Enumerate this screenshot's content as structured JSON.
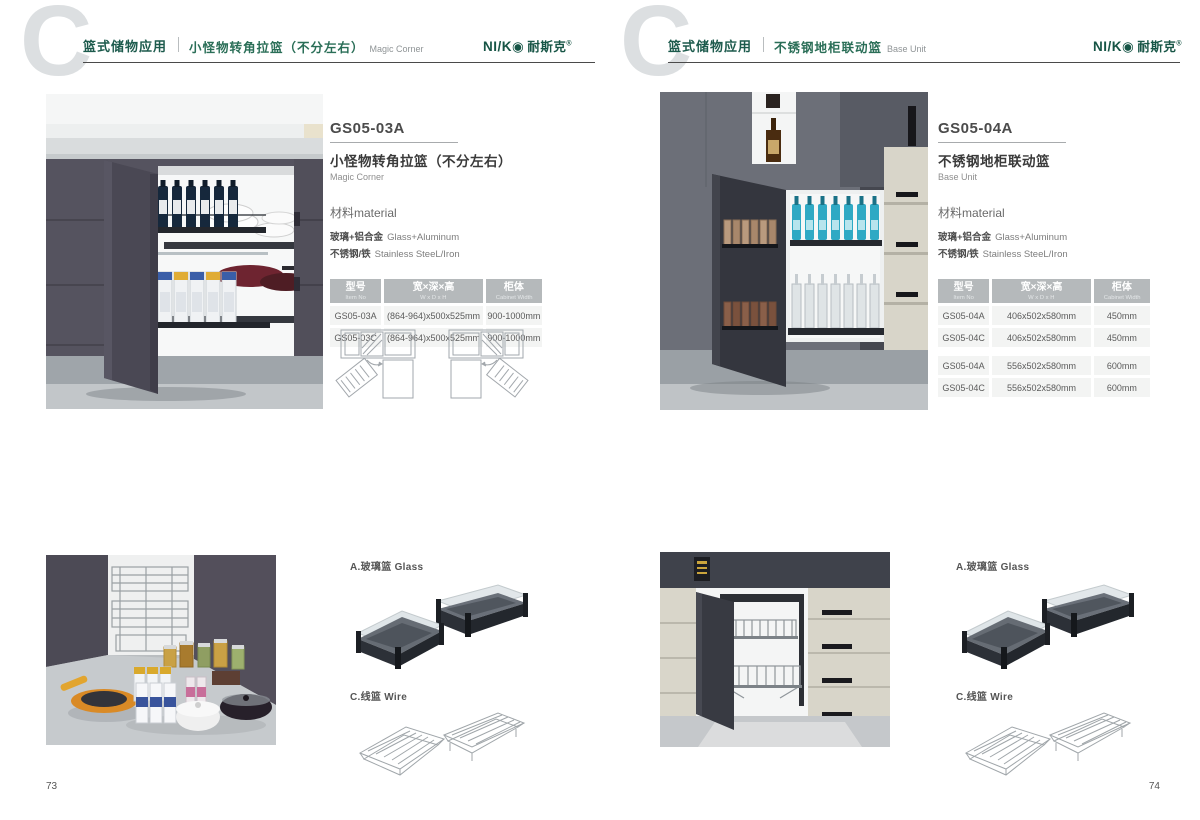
{
  "brand": {
    "logo_name": "NI/K◉",
    "logo_cn": "耐斯克",
    "reg": "®"
  },
  "watermark": "C",
  "material_heading": "材料material",
  "materials": [
    {
      "cn": "玻璃+铝合金",
      "en": "Glass+Aluminum"
    },
    {
      "cn": "不锈钢/铁",
      "en": "Stainless SteeL/Iron"
    }
  ],
  "table_headers": [
    {
      "cn": "型号",
      "en": "Item No"
    },
    {
      "cn": "宽×深×高",
      "en": "W x D x H"
    },
    {
      "cn": "柜体",
      "en": "Cabinet Width"
    }
  ],
  "legend": {
    "glass": "A.玻璃篮 Glass",
    "wire": "C.线篮 Wire"
  },
  "pages": [
    {
      "page_number": "73",
      "header": {
        "category": "篮式储物应用",
        "title_cn": "小怪物转角拉篮（不分左右）",
        "title_en": "Magic Corner"
      },
      "product": {
        "model": "GS05-03A",
        "name_cn": "小怪物转角拉篮（不分左右）",
        "name_en": "Magic Corner"
      },
      "rows": [
        {
          "model": "GS05-03A",
          "size": "(864-964)x500x525mm",
          "cabinet": "900-1000mm"
        },
        {
          "model": "GS05-03C",
          "size": "(864-964)x500x525mm",
          "cabinet": "900-1000mm"
        }
      ]
    },
    {
      "page_number": "74",
      "header": {
        "category": "篮式储物应用",
        "title_cn": "不锈钢地柜联动篮",
        "title_en": "Base Unit"
      },
      "product": {
        "model": "GS05-04A",
        "name_cn": "不锈钢地柜联动篮",
        "name_en": "Base Unit"
      },
      "rows": [
        {
          "model": "GS05-04A",
          "size": "406x502x580mm",
          "cabinet": "450mm"
        },
        {
          "model": "GS05-04C",
          "size": "406x502x580mm",
          "cabinet": "450mm"
        },
        {
          "model": "GS05-04A",
          "size": "556x502x580mm",
          "cabinet": "600mm"
        },
        {
          "model": "GS05-04C",
          "size": "556x502x580mm",
          "cabinet": "600mm"
        }
      ]
    }
  ]
}
